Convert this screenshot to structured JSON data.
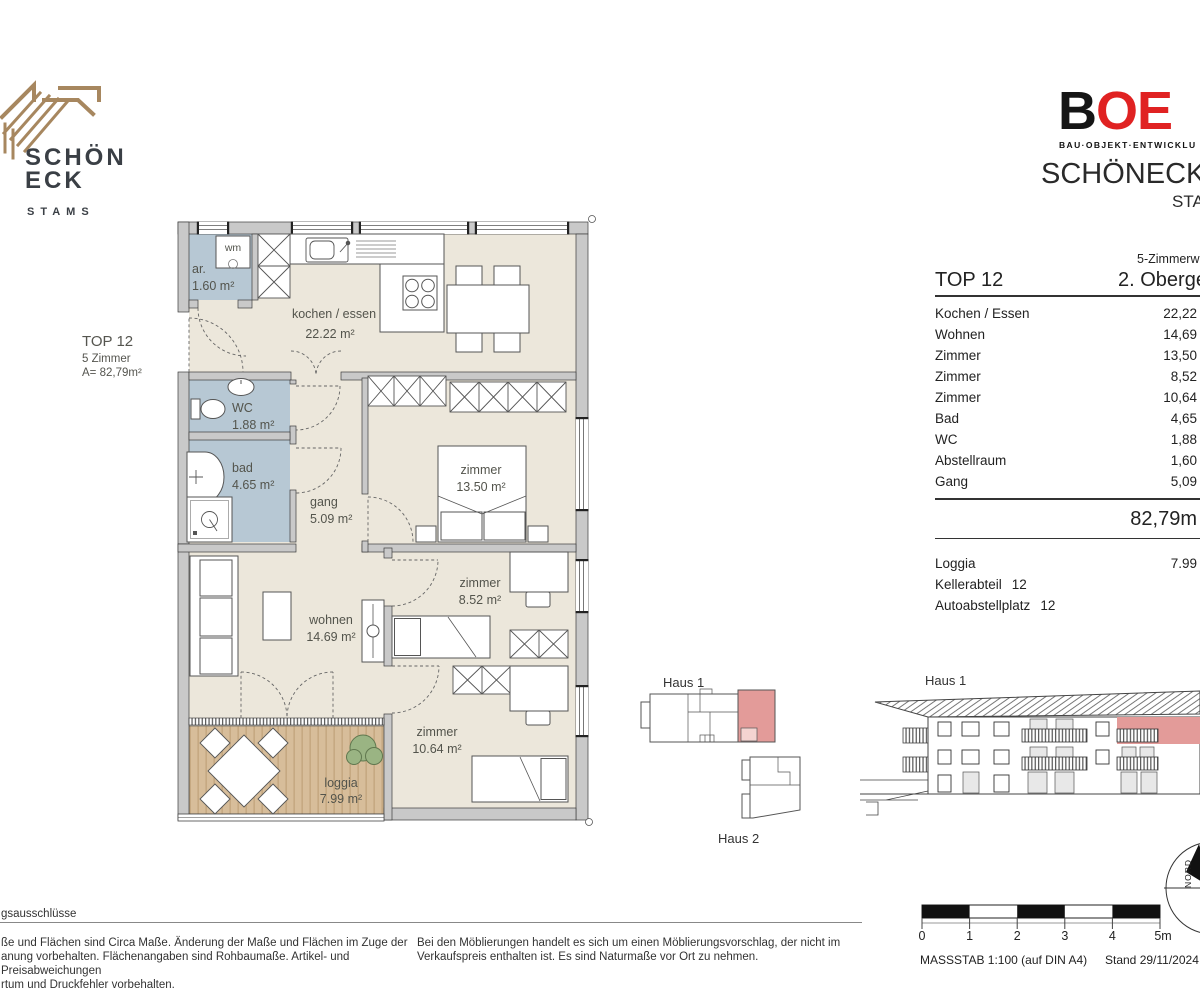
{
  "branding": {
    "schoeneck": {
      "line1": "SCHÖN",
      "line2": "ECK",
      "location": "STAMS"
    },
    "boe": {
      "letters": {
        "b": "B",
        "o": "O",
        "e": "E"
      },
      "tagline": "BAU·OBJEKT·ENTWICKLU",
      "project": "SCHÖNECK 2",
      "project_location": "STA"
    }
  },
  "side_label": {
    "unit": "TOP 12",
    "rooms": "5 Zimmer",
    "area": "A= 82,79m²"
  },
  "plan": {
    "wm": "wm",
    "rooms": [
      {
        "name": "ar.",
        "area": "1.60 m²"
      },
      {
        "name": "kochen / essen",
        "area": "22.22 m²"
      },
      {
        "name": "WC",
        "area": "1.88 m²"
      },
      {
        "name": "bad",
        "area": "4.65 m²"
      },
      {
        "name": "gang",
        "area": "5.09 m²"
      },
      {
        "name": "zimmer",
        "area": "13.50 m²"
      },
      {
        "name": "wohnen",
        "area": "14.69 m²"
      },
      {
        "name": "zimmer",
        "area": "8.52 m²"
      },
      {
        "name": "zimmer",
        "area": "10.64 m²"
      },
      {
        "name": "loggia",
        "area": "7.99 m²"
      }
    ]
  },
  "unit_table": {
    "type_header": "5-Zimmerw",
    "unit": "TOP 12",
    "floor": "2. Oberge",
    "rows": [
      {
        "label": "Kochen / Essen",
        "value": "22,22"
      },
      {
        "label": "Wohnen",
        "value": "14,69"
      },
      {
        "label": "Zimmer",
        "value": "13,50"
      },
      {
        "label": "Zimmer",
        "value": "8,52"
      },
      {
        "label": "Zimmer",
        "value": "10,64"
      },
      {
        "label": "Bad",
        "value": "4,65"
      },
      {
        "label": "WC",
        "value": "1,88"
      },
      {
        "label": "Abstellraum",
        "value": "1,60"
      },
      {
        "label": "Gang",
        "value": "5,09"
      }
    ],
    "total": "82,79m",
    "extras": [
      {
        "label": "Loggia",
        "value": "7.99"
      },
      {
        "label": "Kellerabteil",
        "value": "12"
      },
      {
        "label": "Autoabstellplatz",
        "value": "12"
      }
    ]
  },
  "site_plan": {
    "haus1": "Haus 1",
    "haus2": "Haus 2"
  },
  "elevation": {
    "haus1": "Haus 1"
  },
  "footer": {
    "exclusions_header": "gsausschlüsse",
    "disclaimer_left": [
      "ße und Flächen sind Circa Maße. Änderung der Maße und Flächen im Zuge der",
      "anung vorbehalten. Flächenangaben sind Rohbaumaße. Artikel- und Preisabweichungen",
      "rtum und Druckfehler vorbehalten."
    ],
    "disclaimer_center": "Bei den Möblierungen handelt es sich um einen Möblierungsvorschlag, der nicht im Verkaufspreis enthalten ist. Es sind Naturmaße vor Ort zu nehmen.",
    "scale_ticks": [
      "0",
      "1",
      "2",
      "3",
      "4",
      "5m"
    ],
    "scale_label": "MASSSTAB  1:100 (auf DIN A4)",
    "date_label": "Stand 29/11/2024",
    "north_label": "NORD"
  },
  "colors": {
    "accent_red": "#e39b99",
    "accent_red_light": "#f4d4d1",
    "floor_beige": "#ece7db",
    "wet_room_blue": "#b7c8d4",
    "loggia_wood": "#d7bd9a",
    "wall_gray": "#c9c9c9",
    "logo_gold": "#a7875f",
    "boe_red": "#e02222"
  }
}
